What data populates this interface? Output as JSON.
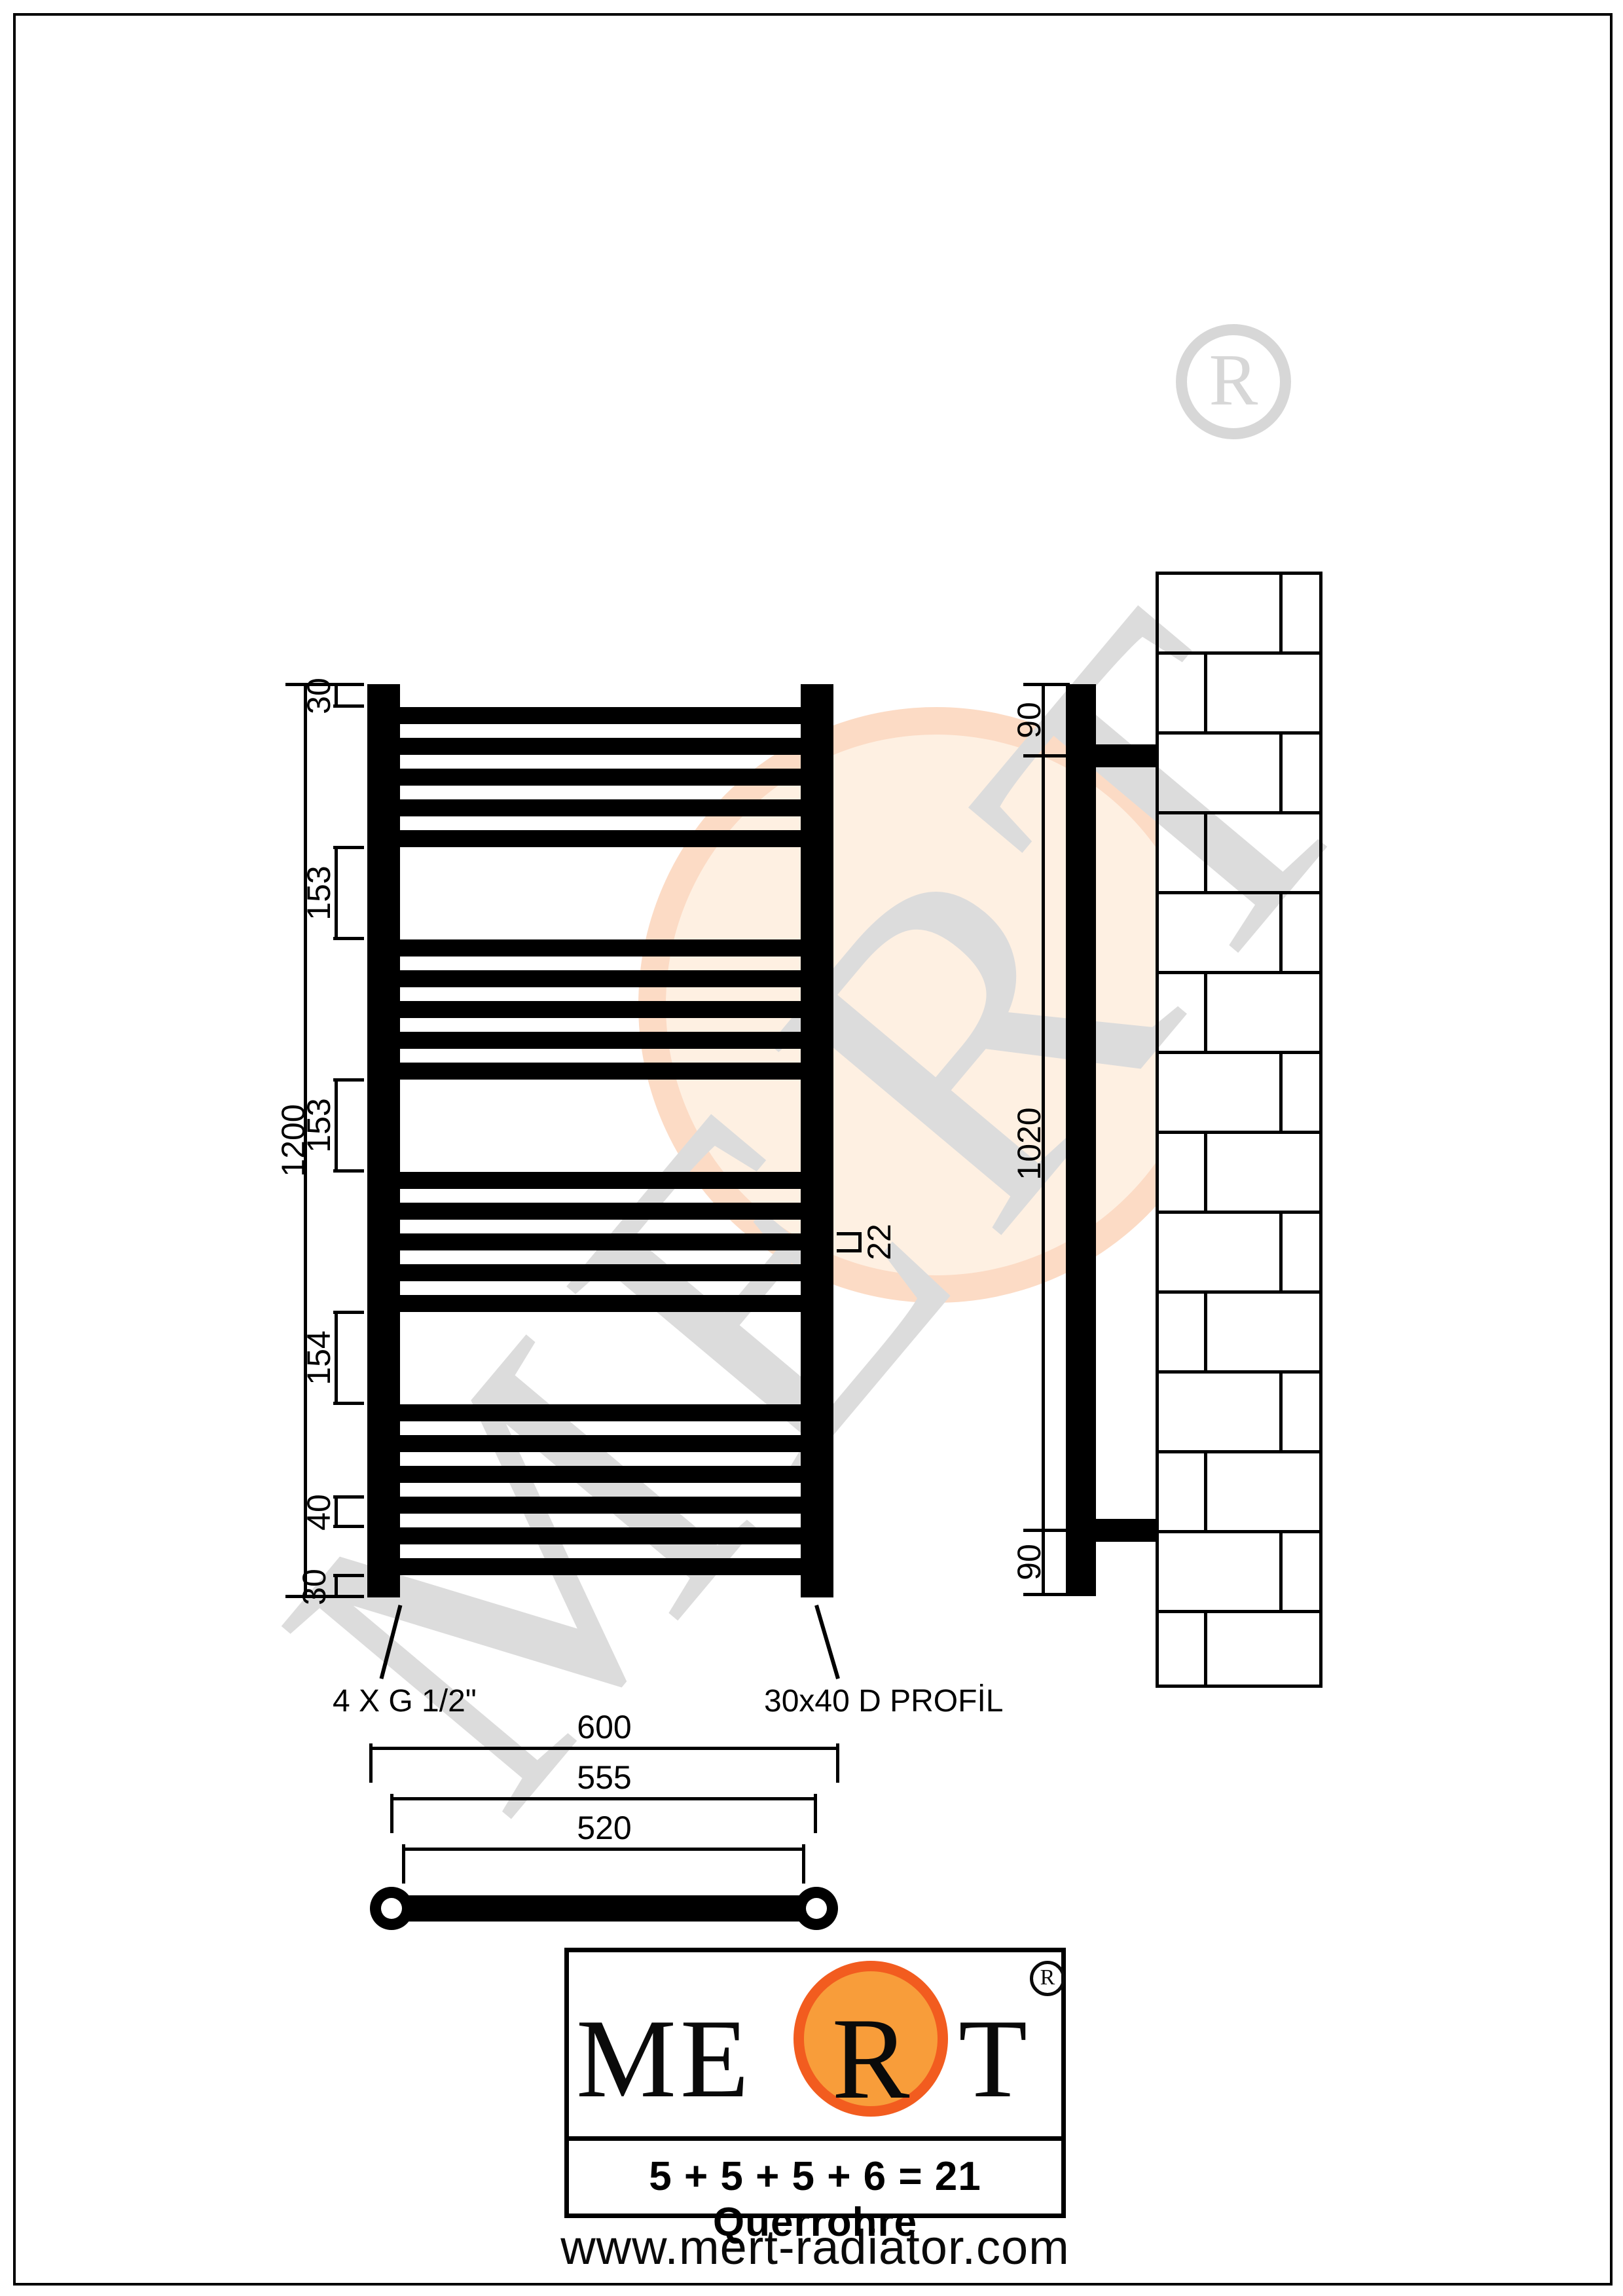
{
  "watermark": {
    "brand": "MERT",
    "registered_letter": "R"
  },
  "front_view": {
    "height_label": "1200",
    "top_offset_label": "30",
    "gap1_label": "153",
    "gap2_label": "153",
    "gap3_label": "154",
    "pitch_label": "40",
    "bottom_offset_label": "30",
    "tube_label": "22"
  },
  "side_view": {
    "top_label": "90",
    "middle_label": "1020",
    "bottom_label": "90"
  },
  "top_view": {
    "overall_label": "600",
    "pitch_label": "555",
    "inner_label": "520"
  },
  "annotations": {
    "connections": "4 X G 1/2\"",
    "profile": "30x40 D PROFİL"
  },
  "logo": {
    "word_before": "ME",
    "accent_letter": "R",
    "word_after": "T",
    "registered": "R"
  },
  "footer": {
    "formula": "5 + 5 + 5 + 6 = 21 Querrohre",
    "website": "www.mert-radiator.com"
  },
  "radiator": {
    "groups": [
      5,
      5,
      5,
      6
    ],
    "total_rungs": 21
  },
  "colors": {
    "accent_ring": "#f25c1f",
    "accent_fill": "#f89d3a",
    "watermark_gray": "#dcdcdc"
  }
}
